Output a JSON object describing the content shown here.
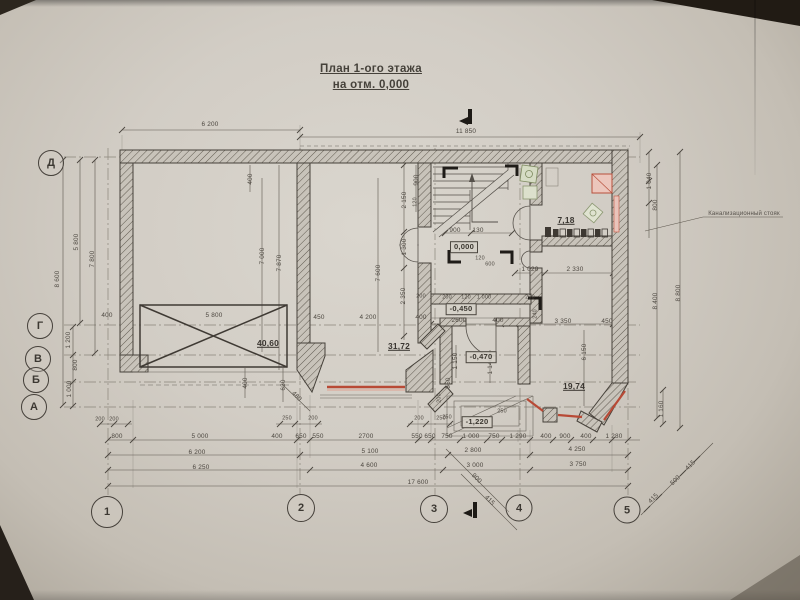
{
  "meta": {
    "type": "architectural-floor-plan",
    "language": "ru"
  },
  "title": {
    "line1": "План 1-ого этажа",
    "line2": "на отм. 0,000"
  },
  "axes": {
    "row_labels": [
      "Д",
      "Г",
      "В",
      "Б",
      "А"
    ],
    "column_labels": [
      "1",
      "2",
      "3",
      "4",
      "5"
    ]
  },
  "levels": {
    "hall": "0,000",
    "porch": "-0,450",
    "tambour": "-0,470",
    "entrance": "-1,220"
  },
  "areas": {
    "garage": "40,60",
    "living_room": "31,72",
    "bathroom": "7,18",
    "bay_room": "19,74"
  },
  "notes": {
    "sewer_riser": "Канализационный стояк"
  },
  "colors": {
    "paper": "#d2cdc5",
    "ink": "#4b463f",
    "wall": "#46413a",
    "highlight_red": "#b84a36",
    "fixture_green": "#8a9670"
  },
  "drawing": {
    "axis_circles": [
      {
        "t": "Д",
        "x": 51,
        "y": 163,
        "d": 24
      },
      {
        "t": "Г",
        "x": 40,
        "y": 326,
        "d": 24
      },
      {
        "t": "В",
        "x": 38,
        "y": 359,
        "d": 24
      },
      {
        "t": "Б",
        "x": 36,
        "y": 380,
        "d": 24
      },
      {
        "t": "А",
        "x": 34,
        "y": 407,
        "d": 24
      },
      {
        "t": "1",
        "x": 107,
        "y": 512,
        "d": 30
      },
      {
        "t": "2",
        "x": 301,
        "y": 508,
        "d": 26
      },
      {
        "t": "3",
        "x": 434,
        "y": 509,
        "d": 26
      },
      {
        "t": "4",
        "x": 519,
        "y": 508,
        "d": 25
      },
      {
        "t": "5",
        "x": 627,
        "y": 510,
        "d": 25
      }
    ],
    "labels": [
      {
        "t": "6 200",
        "x": 210,
        "y": 125
      },
      {
        "t": "11 850",
        "x": 466,
        "y": 132
      },
      {
        "t": "5 800",
        "x": 77,
        "y": 242,
        "r": -90
      },
      {
        "t": "7 800",
        "x": 93,
        "y": 259,
        "r": -90
      },
      {
        "t": "8 600",
        "x": 58,
        "y": 279,
        "r": -90
      },
      {
        "t": "1 200",
        "x": 69,
        "y": 340,
        "r": -90
      },
      {
        "t": "800",
        "x": 76,
        "y": 365,
        "r": -90
      },
      {
        "t": "1 000",
        "x": 70,
        "y": 389,
        "r": -90
      },
      {
        "t": "400",
        "x": 107,
        "y": 316
      },
      {
        "t": "400",
        "x": 251,
        "y": 179,
        "r": -90
      },
      {
        "t": "7 000",
        "x": 263,
        "y": 256,
        "r": -90
      },
      {
        "t": "7 870",
        "x": 280,
        "y": 263,
        "r": -90
      },
      {
        "t": "5 800",
        "x": 214,
        "y": 316
      },
      {
        "t": "40,60",
        "x": 268,
        "y": 343,
        "c": "area",
        "n": "area-garage"
      },
      {
        "t": "400",
        "x": 246,
        "y": 383,
        "r": -90
      },
      {
        "t": "630",
        "x": 284,
        "y": 385,
        "r": -90
      },
      {
        "t": "480",
        "x": 296,
        "y": 397,
        "r": 45
      },
      {
        "t": "7 600",
        "x": 379,
        "y": 273,
        "r": -90
      },
      {
        "t": "450",
        "x": 319,
        "y": 318
      },
      {
        "t": "4 200",
        "x": 368,
        "y": 318
      },
      {
        "t": "400",
        "x": 421,
        "y": 318
      },
      {
        "t": "31,72",
        "x": 399,
        "y": 346,
        "c": "area",
        "n": "area-living-room"
      },
      {
        "t": "900",
        "x": 417,
        "y": 180,
        "r": -90
      },
      {
        "t": "2 150",
        "x": 405,
        "y": 200,
        "r": -90
      },
      {
        "t": "120",
        "x": 416,
        "y": 202,
        "r": -90,
        "c": "tiny"
      },
      {
        "t": "1 300",
        "x": 405,
        "y": 247,
        "r": -90
      },
      {
        "t": "2 350",
        "x": 404,
        "y": 296,
        "r": -90
      },
      {
        "t": "200",
        "x": 421,
        "y": 297,
        "c": "tiny"
      },
      {
        "t": "900",
        "x": 455,
        "y": 231
      },
      {
        "t": "130",
        "x": 478,
        "y": 231
      },
      {
        "t": "0,000",
        "x": 464,
        "y": 247,
        "c": "level",
        "n": "level-hall"
      },
      {
        "t": "120",
        "x": 480,
        "y": 259,
        "c": "tiny"
      },
      {
        "t": "600",
        "x": 490,
        "y": 265,
        "c": "tiny"
      },
      {
        "t": "1 020",
        "x": 530,
        "y": 270
      },
      {
        "t": "2 330",
        "x": 575,
        "y": 270
      },
      {
        "t": "200",
        "x": 447,
        "y": 298,
        "c": "tiny"
      },
      {
        "t": "120",
        "x": 466,
        "y": 298,
        "c": "tiny"
      },
      {
        "t": "1 000",
        "x": 484,
        "y": 298,
        "c": "tiny"
      },
      {
        "t": "200",
        "x": 530,
        "y": 298,
        "c": "tiny"
      },
      {
        "t": "-0,450",
        "x": 461,
        "y": 309,
        "c": "level",
        "n": "level-porch"
      },
      {
        "t": "2600",
        "x": 459,
        "y": 321
      },
      {
        "t": "400",
        "x": 498,
        "y": 321
      },
      {
        "t": "240",
        "x": 536,
        "y": 314,
        "r": -90,
        "c": "tiny"
      },
      {
        "t": "3 350",
        "x": 563,
        "y": 322
      },
      {
        "t": "450",
        "x": 607,
        "y": 322
      },
      {
        "t": "6 150",
        "x": 585,
        "y": 352,
        "r": -90
      },
      {
        "t": "1 150",
        "x": 456,
        "y": 361,
        "r": -90
      },
      {
        "t": "1 140",
        "x": 491,
        "y": 366,
        "r": -90
      },
      {
        "t": "550",
        "x": 449,
        "y": 383,
        "r": -90
      },
      {
        "t": "200",
        "x": 440,
        "y": 398,
        "r": -90,
        "c": "tiny"
      },
      {
        "t": "-0,470",
        "x": 481,
        "y": 357,
        "c": "level",
        "n": "level-tambour"
      },
      {
        "t": "19,74",
        "x": 574,
        "y": 386,
        "c": "area",
        "n": "area-bay-room"
      },
      {
        "t": "-1,220",
        "x": 477,
        "y": 422,
        "c": "level",
        "n": "level-entrance"
      },
      {
        "t": "250",
        "x": 447,
        "y": 418,
        "c": "tiny"
      },
      {
        "t": "250",
        "x": 502,
        "y": 412,
        "c": "tiny"
      },
      {
        "t": "7,18",
        "x": 566,
        "y": 220,
        "c": "area",
        "n": "area-bathroom"
      },
      {
        "t": "1 040",
        "x": 650,
        "y": 181,
        "r": -90
      },
      {
        "t": "800",
        "x": 656,
        "y": 205,
        "r": -90
      },
      {
        "t": "8 400",
        "x": 656,
        "y": 301,
        "r": -90
      },
      {
        "t": "8 800",
        "x": 679,
        "y": 293,
        "r": -90
      },
      {
        "t": "1 160",
        "x": 662,
        "y": 409,
        "r": -90
      },
      {
        "t": "Канализационный стояк",
        "x": 744,
        "y": 214,
        "c": "note",
        "n": "sewer-riser-note"
      },
      {
        "t": "200",
        "x": 100,
        "y": 420,
        "c": "tiny"
      },
      {
        "t": "200",
        "x": 114,
        "y": 420,
        "c": "tiny"
      },
      {
        "t": "250",
        "x": 287,
        "y": 419,
        "c": "tiny"
      },
      {
        "t": "200",
        "x": 313,
        "y": 419,
        "c": "tiny"
      },
      {
        "t": "200",
        "x": 419,
        "y": 419,
        "c": "tiny"
      },
      {
        "t": "250",
        "x": 441,
        "y": 419,
        "c": "tiny"
      },
      {
        "t": "800",
        "x": 117,
        "y": 437
      },
      {
        "t": "5 000",
        "x": 200,
        "y": 437
      },
      {
        "t": "400",
        "x": 277,
        "y": 437
      },
      {
        "t": "650",
        "x": 301,
        "y": 437
      },
      {
        "t": "550",
        "x": 318,
        "y": 437
      },
      {
        "t": "2700",
        "x": 366,
        "y": 437
      },
      {
        "t": "550",
        "x": 417,
        "y": 437
      },
      {
        "t": "650",
        "x": 430,
        "y": 437
      },
      {
        "t": "750",
        "x": 447,
        "y": 437
      },
      {
        "t": "1 000",
        "x": 471,
        "y": 437
      },
      {
        "t": "750",
        "x": 494,
        "y": 437
      },
      {
        "t": "1 290",
        "x": 518,
        "y": 437
      },
      {
        "t": "400",
        "x": 546,
        "y": 437
      },
      {
        "t": "900",
        "x": 565,
        "y": 437
      },
      {
        "t": "400",
        "x": 586,
        "y": 437
      },
      {
        "t": "1 280",
        "x": 614,
        "y": 437
      },
      {
        "t": "6 200",
        "x": 197,
        "y": 453
      },
      {
        "t": "5 100",
        "x": 370,
        "y": 452
      },
      {
        "t": "2 800",
        "x": 473,
        "y": 451
      },
      {
        "t": "4 250",
        "x": 577,
        "y": 450
      },
      {
        "t": "6 250",
        "x": 201,
        "y": 468
      },
      {
        "t": "4 600",
        "x": 369,
        "y": 466
      },
      {
        "t": "3 000",
        "x": 475,
        "y": 466
      },
      {
        "t": "3 750",
        "x": 578,
        "y": 465
      },
      {
        "t": "17 600",
        "x": 418,
        "y": 483
      },
      {
        "t": "900",
        "x": 476,
        "y": 479,
        "r": 45
      },
      {
        "t": "415",
        "x": 489,
        "y": 501,
        "r": 45
      },
      {
        "t": "415",
        "x": 654,
        "y": 499,
        "r": -45
      },
      {
        "t": "500",
        "x": 676,
        "y": 481,
        "r": -45
      },
      {
        "t": "415",
        "x": 691,
        "y": 466,
        "r": -45
      }
    ]
  }
}
